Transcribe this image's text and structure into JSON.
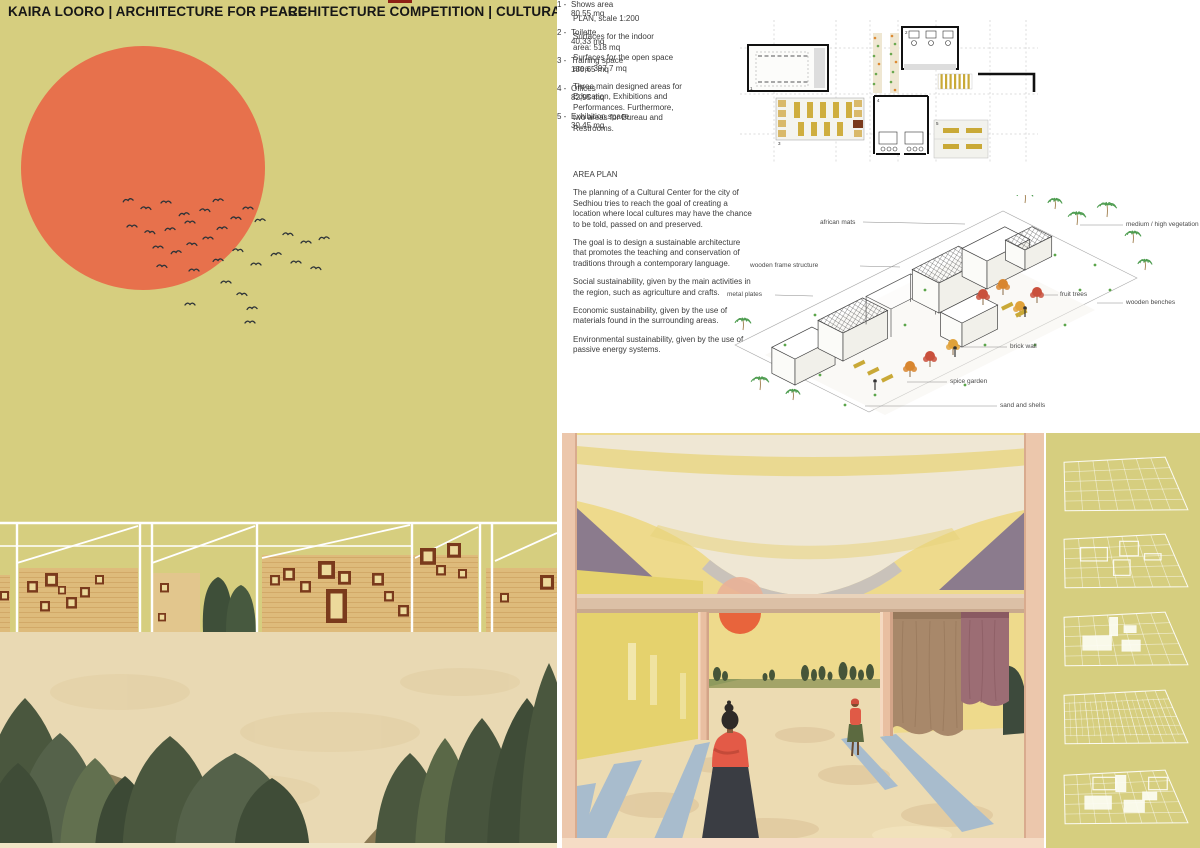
{
  "header": {
    "title_left": "KAIRA LOORO  | ARCHITECTURE FOR PEACE",
    "title_right": "ARCHITECTURE COMPETITION | CULTURAL CENTER"
  },
  "plan_section": {
    "heading": "PLAN, scale 1:200",
    "surface_lines": [
      "Surfaces for the indoor",
      "area: 518 mq",
      "Surfaces for the open space",
      "area: 397,7 mq"
    ],
    "note": "Three main designed areas for Education, Exhibitions and Performances. Furthermore, two areas for Bureau and Restrooms.",
    "legend": [
      {
        "num": "1 -",
        "label": "Shows area",
        "area": "80,55 mq"
      },
      {
        "num": "2 -",
        "label": "Toilette",
        "area": "40,33 mq"
      },
      {
        "num": "3 -",
        "label": "Training space",
        "area": "130,65 mq"
      },
      {
        "num": "4 -",
        "label": "Offices",
        "area": "82,95 mq"
      },
      {
        "num": "5 -",
        "label": "Exhibition space",
        "area": "30,45 mq"
      }
    ]
  },
  "area_plan": {
    "heading": "AREA PLAN",
    "paragraphs": [
      "The planning of a Cultural Center for the city of Sedhiou tries to reach the goal of creating a location where local cultures may have the chance to be told, passed on and preserved.",
      "The goal is to design a sustainable architecture that promotes the teaching and conservation of traditions through a contemporary language.",
      "Social sustainability, given by the main activities in the region, such as agriculture and crafts.",
      "Economic sustainability, given by the use of materials found in the surrounding areas.",
      "Environmental sustainability, given by the use of passive energy systems."
    ]
  },
  "axo": {
    "labels": [
      "african mats",
      "wooden frame structure",
      "metal plates",
      "medium / high vegetation",
      "fruit trees",
      "wooden benches",
      "brick wall",
      "spice garden",
      "sand and shells"
    ]
  },
  "colors": {
    "panel_yellow": "#d6ce7f",
    "sun_orange": "#e7714c",
    "ink": "#1f1f1f",
    "text_grey": "#3c3c3c",
    "wall_tan": "#debb7b",
    "window_brown": "#7a3a1c",
    "window_pane": "#ecd99b",
    "tree_green": "#4a573e",
    "ground_cream": "#e9d9b3",
    "interior_sky": "#eeda8c",
    "canopy_cream": "#efe7d4",
    "column_salmon": "#ecc7ac",
    "shadow_blue": "#a8bccd",
    "fabric_brown": "#a8886a",
    "fabric_plum": "#9c6d74",
    "figure_red": "#e05a46",
    "gold": "#c9a937",
    "accent_red_mark": "#8e1f15"
  }
}
